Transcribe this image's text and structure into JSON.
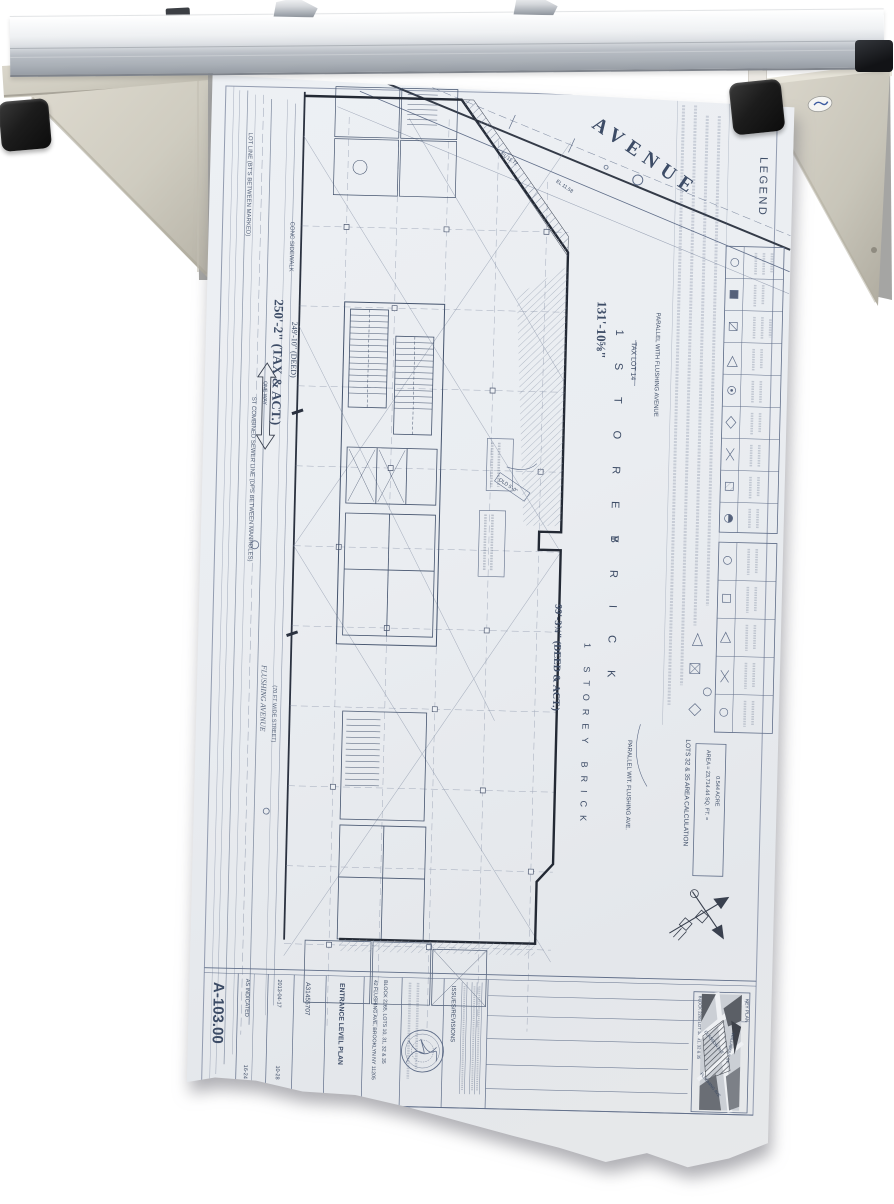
{
  "photo": {
    "description_label": "blueprint wall rack with hanging plan",
    "colors": {
      "wall": "#ffffff",
      "rail_silver": "#d7dade",
      "bracket_putty": "#d8d4c8",
      "rubber_cap": "#1d1d1d",
      "paper": "#eaedf1",
      "ink_blue": "#3d4c66",
      "ink_heavy": "#262b34"
    }
  },
  "sheet": {
    "street_label": "AVENUE",
    "dimensions": {
      "d1": "250'-2\" (TAX & ACT.)",
      "d1b": "249'-10\" (DEED)",
      "d2": "131'-10⅝\"",
      "d3": "99'-3¾\" (DEED & ACT.)"
    },
    "labels": {
      "storey1a": "1 S T O R E Y",
      "storey1b": "B R I C K",
      "storey2": "1 STOREY BRICK",
      "parallel1": "PARALLEL WITH FLUSHING AVENUE",
      "parallel2": "PARALLEL WIT. FLUSHING AVE.",
      "tax_lot": "TAX LOT 14",
      "one_way": "ONE WAY",
      "el1": "EL 11.58",
      "el2": "EL 11.72",
      "old_label": "OLD 5'-0\""
    },
    "margin_notes": [
      "LOT LINE (BT'S BETWEEN MARKED)",
      "CONC SIDEWALK",
      "ST COMBINED SEWER LINE (DPS BETWEEN MANHOLES)",
      "FLUSHING AVENUE",
      "(70 FT WIDE STREET)"
    ],
    "legend": {
      "title": "LEGEND"
    },
    "area_calc": {
      "title": "LOTS 32 & 35 AREA CALCULATION",
      "line1": "AREA = 23,714.44 SQ. FT. =",
      "line2": "0.544 ACRE"
    },
    "title_block": {
      "sheet_no": "A-103.00",
      "scale": "AS INDICATED",
      "scale2": "16-24",
      "date": "2013-04-17",
      "date2": "10-28",
      "job_no": "A31455707",
      "title": "ENTRANCE LEVEL PLAN",
      "address1": "42 FLUSHING AVE, BROOKLYN NY 11205",
      "address2": "BLOCK 2265, LOTS 10, 31, 32 & 35",
      "revisions_label": "ISSUES/REVISIONS",
      "key_plan": {
        "label": "KEY PLAN",
        "block": "BLOCK 2265 LOT 10, 31, 32 & 35",
        "street1": "CLASSON AVE",
        "street2": "FLUSHING AVE",
        "street3": "WALLABOUT ST"
      }
    }
  }
}
